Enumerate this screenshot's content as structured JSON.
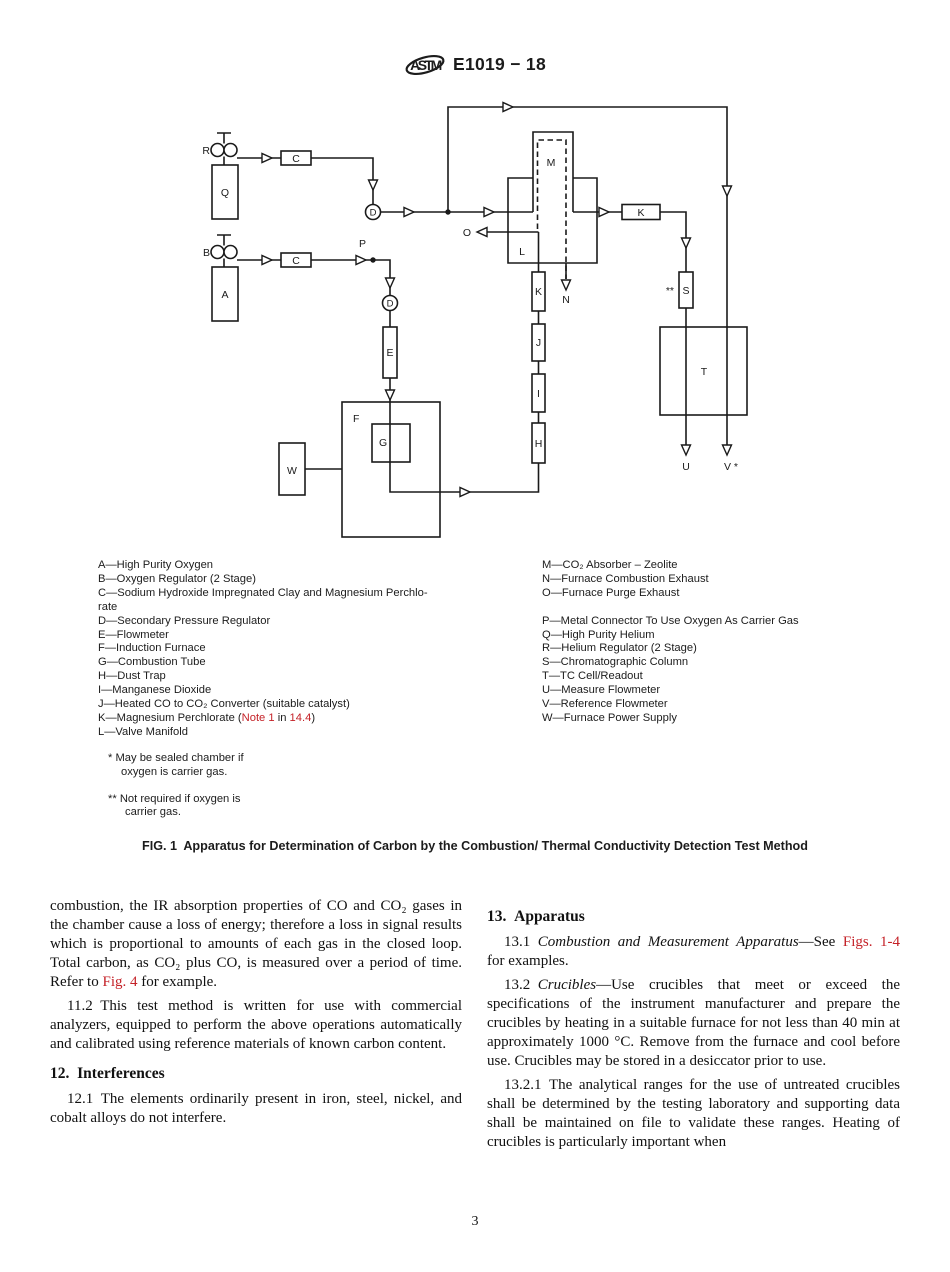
{
  "header": {
    "code": "E1019 − 18"
  },
  "diagram": {
    "nodes": {
      "r": "R",
      "q": "Q",
      "b": "B",
      "a": "A",
      "c1": "C",
      "c2": "C",
      "d1": "D",
      "d2": "D",
      "p": "P",
      "e": "E",
      "f": "F",
      "g": "G",
      "w": "W",
      "h": "H",
      "i": "I",
      "j": "J",
      "k_chain": "K",
      "k_inline": "K",
      "l": "L",
      "m": "M",
      "n": "N",
      "o": "O",
      "s": "S",
      "s_note": "**",
      "t": "T",
      "u": "U",
      "v": "V *"
    }
  },
  "legend": {
    "left": [
      "A—High Purity Oxygen",
      "B—Oxygen Regulator (2 Stage)",
      "C—Sodium Hydroxide Impregnated Clay and Magnesium Perchlo-\nrate",
      "D—Secondary Pressure Regulator",
      "E—Flowmeter",
      "F—Induction Furnace",
      "G—Combustion Tube",
      "H—Dust Trap",
      "I—Manganese Dioxide",
      "J—Heated CO to CO₂ Converter (suitable catalyst)"
    ],
    "k": {
      "prefix": "K—Magnesium Perchlorate (",
      "link1": "Note 1",
      "mid": " in ",
      "link2": "14.4",
      "suffix": ")"
    },
    "l_item": "L—Valve Manifold",
    "right": [
      "M—CO₂ Absorber – Zeolite",
      "N—Furnace Combustion Exhaust",
      "O—Furnace Purge Exhaust",
      "P—Metal Connector To Use Oxygen As Carrier Gas",
      "Q—High Purity Helium",
      "R—Helium Regulator (2 Stage)",
      "S—Chromatographic Column",
      "T—TC Cell/Readout",
      "U—Measure Flowmeter",
      "V—Reference Flowmeter",
      "W—Furnace Power Supply"
    ]
  },
  "footnotes": {
    "f1": "* May be sealed chamber if\noxygen is carrier gas.",
    "f2": "** Not required if oxygen is\ncarrier gas."
  },
  "caption": "FIG. 1 Apparatus for Determination of Carbon by the Combustion/ Thermal Conductivity Detection Test Method",
  "body": {
    "left": {
      "p1a": "combustion, the IR absorption properties of CO and CO₂ gases in the chamber cause a loss of energy; therefore a loss in signal results which is proportional to amounts of each gas in the closed loop. Total carbon, as CO₂ plus CO, is measured over a period of time. Refer to ",
      "p1_link": "Fig. 4",
      "p1b": " for example.",
      "p2": "11.2 This test method is written for use with commercial analyzers, equipped to perform the above operations automatically and calibrated using reference materials of known carbon content.",
      "h12": "12. Interferences",
      "p3": "12.1 The elements ordinarily present in iron, steel, nickel, and cobalt alloys do not interfere."
    },
    "right": {
      "h13": "13. Apparatus",
      "p131_num": "13.1 ",
      "p131_it": "Combustion and Measurement Apparatus",
      "p131_mid": "—See ",
      "p131_link": "Figs. 1-4",
      "p131_end": " for examples.",
      "p132_num": "13.2 ",
      "p132_it": "Crucibles",
      "p132_rest": "—Use crucibles that meet or exceed the specifications of the instrument manufacturer and prepare the crucibles by heating in a suitable furnace for not less than 40 min at approximately 1000 °C. Remove from the furnace and cool before use. Crucibles may be stored in a desiccator prior to use.",
      "p1321": "13.2.1 The analytical ranges for the use of untreated crucibles shall be determined by the testing laboratory and supporting data shall be maintained on file to validate these ranges. Heating of crucibles is particularly important when"
    }
  },
  "page_number": "3"
}
